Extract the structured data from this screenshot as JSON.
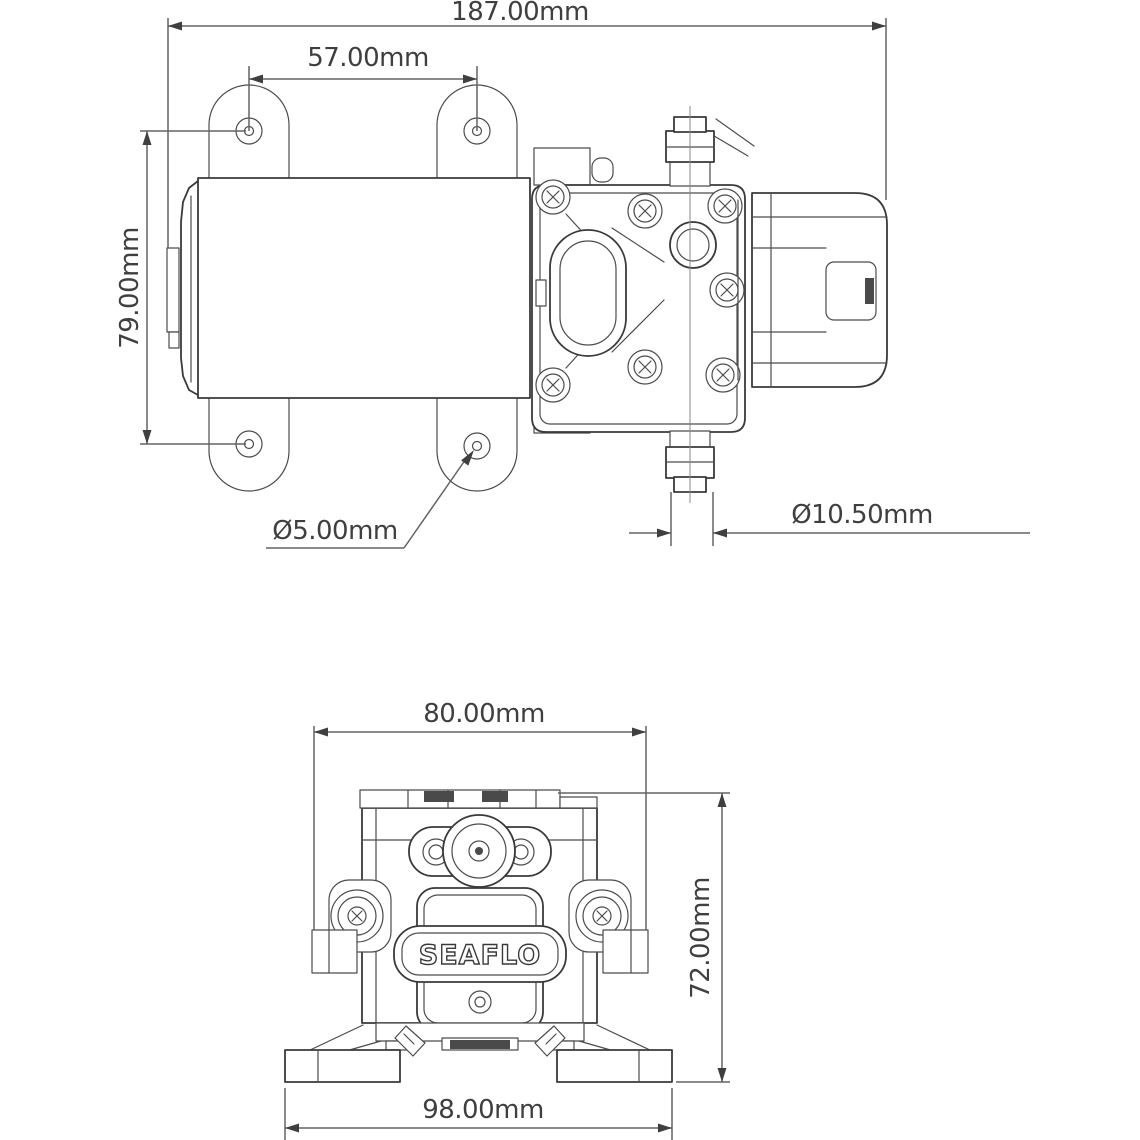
{
  "drawing": {
    "brand_logo": "SEAFLO",
    "colors": {
      "line": "#3a3a3a",
      "dimension": "#636363",
      "background": "#ffffff",
      "text": "#3f3f3f"
    },
    "views": {
      "side": {
        "title": "pump-side-elevation",
        "dims": {
          "overall_length": "187.00mm",
          "mount_hole_spacing": "57.00mm",
          "mount_hole_vertical_spacing": "79.00mm",
          "mount_hole_diameter": "Ø5.00mm",
          "port_diameter": "Ø10.50mm"
        }
      },
      "front": {
        "title": "pump-front-elevation",
        "dims": {
          "overall_width": "80.00mm",
          "overall_height": "72.00mm",
          "base_width": "98.00mm"
        }
      }
    }
  }
}
